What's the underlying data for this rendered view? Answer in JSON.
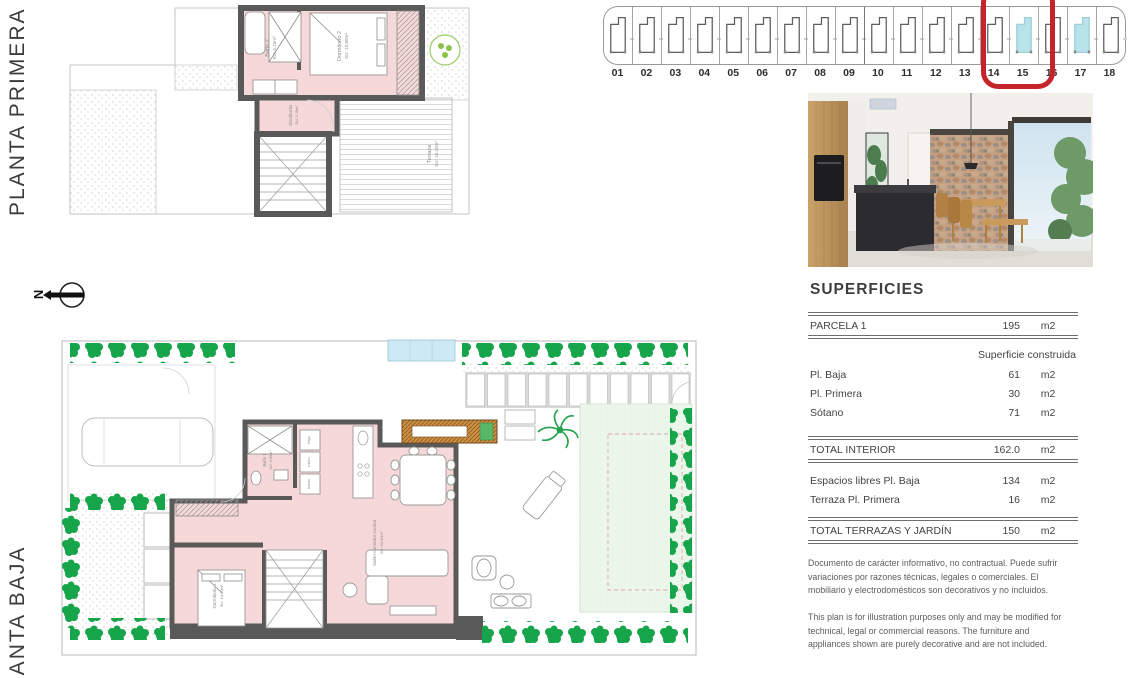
{
  "left_rail": {
    "planta_primera_label": "PLANTA PRIMERA",
    "planta_baja_label": "PLANTA BAJA",
    "north_label": "N"
  },
  "site_strip": {
    "units": [
      "01",
      "02",
      "03",
      "04",
      "05",
      "06",
      "07",
      "08",
      "09",
      "10",
      "11",
      "12",
      "13",
      "14",
      "15",
      "16",
      "17",
      "18"
    ],
    "highlighted_units": [
      "15",
      "17"
    ],
    "ringed_unit": "15",
    "highlight_color": "#b9e3ea",
    "ring_color": "#c5242b"
  },
  "planta_primera": {
    "rooms": [
      {
        "name": "Baño 2",
        "area": "SU: 4.15m²"
      },
      {
        "name": "Dormitorio 2",
        "area": "SU: 10.80m²"
      },
      {
        "name": "Distribuidor",
        "area": "SU: 2.15m²"
      },
      {
        "name": "Terraza",
        "area": "SU: 16.20m²"
      }
    ]
  },
  "planta_baja": {
    "rooms": [
      {
        "name": "Baño 1",
        "area": "SU: 3.90m²"
      },
      {
        "name": "Dormitorio 1",
        "area": "SU: 10.90m²"
      },
      {
        "name": "Salón-comedor-cocina",
        "area": "SU: 33.00m²"
      }
    ],
    "kitchen_labels": [
      "frigo",
      "micro",
      "horno"
    ]
  },
  "superficies": {
    "title": "SUPERFICIES",
    "parcela_row": {
      "label": "PARCELA 1",
      "value": "195",
      "unit": "m2"
    },
    "col_header": "Superficie construida",
    "built_rows": [
      {
        "label": "Pl. Baja",
        "value": "61",
        "unit": "m2"
      },
      {
        "label": "Pl. Primera",
        "value": "30",
        "unit": "m2"
      },
      {
        "label": "Sótano",
        "value": "71",
        "unit": "m2"
      }
    ],
    "total_interior": {
      "label": "TOTAL INTERIOR",
      "value": "162.0",
      "unit": "m2"
    },
    "open_rows": [
      {
        "label": "Espacios libres Pl. Baja",
        "value": "134",
        "unit": "m2"
      },
      {
        "label": "Terraza Pl. Primera",
        "value": "16",
        "unit": "m2"
      }
    ],
    "total_terrazas": {
      "label": "TOTAL TERRAZAS Y JARDÍN",
      "value": "150",
      "unit": "m2"
    },
    "disclaimer_es": "Documento de carácter informativo, no contractual. Puede sufrir variaciones por razones técnicas, legales o comerciales. El mobiliario y electrodomésticos son decorativos y no incluidos.",
    "disclaimer_en": "This plan is for illustration purposes only and may be modified for technical, legal or commercial reasons. The furniture and appliances shown are purely decorative and are not included."
  }
}
